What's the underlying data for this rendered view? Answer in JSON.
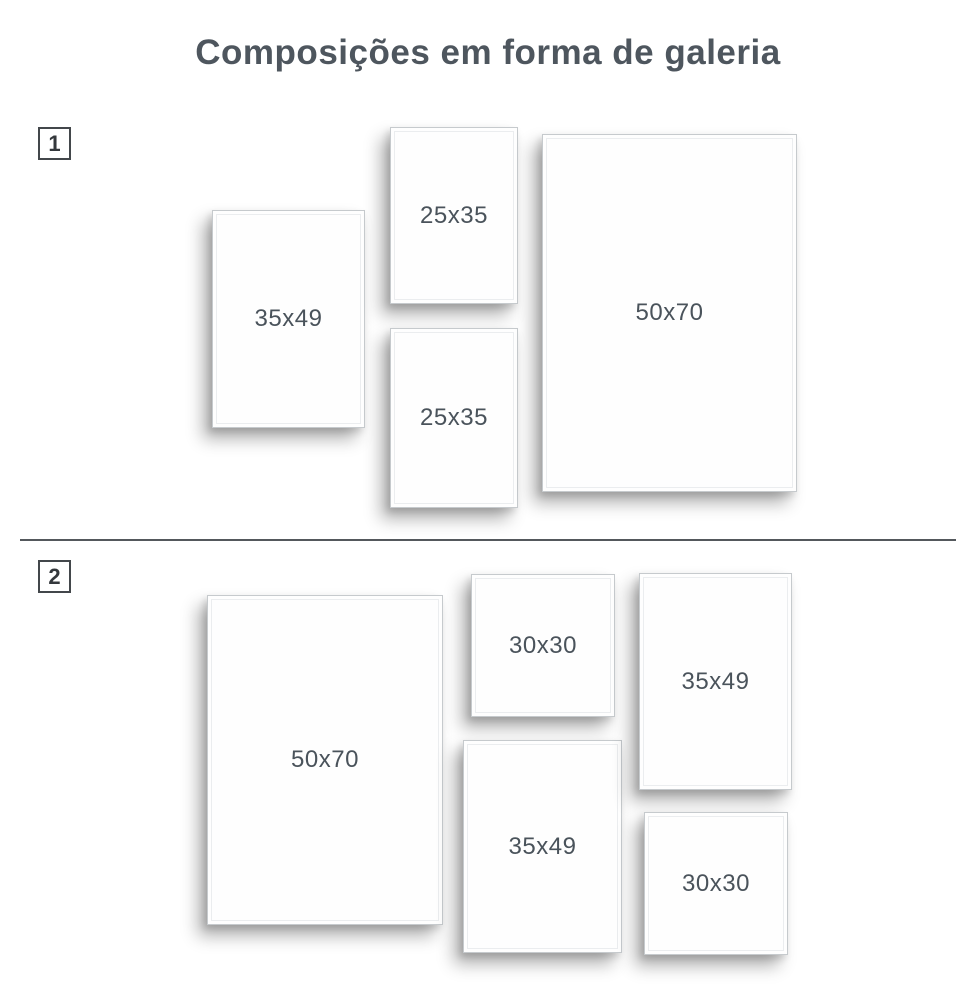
{
  "page": {
    "title": "Composições em forma de galeria"
  },
  "colors": {
    "title_text": "#4e565e",
    "label_text": "#4a535b",
    "frame_border": "#c6cacd",
    "divider": "#54585c",
    "badge_border": "#43474b",
    "background": "#ffffff"
  },
  "sections": [
    {
      "number": "1",
      "frames": [
        {
          "label": "35x49",
          "x": 212,
          "y": 210,
          "w": 153,
          "h": 218
        },
        {
          "label": "25x35",
          "x": 390,
          "y": 127,
          "w": 128,
          "h": 177
        },
        {
          "label": "25x35",
          "x": 390,
          "y": 328,
          "w": 128,
          "h": 180
        },
        {
          "label": "50x70",
          "x": 542,
          "y": 134,
          "w": 255,
          "h": 358
        }
      ]
    },
    {
      "number": "2",
      "frames": [
        {
          "label": "50x70",
          "x": 207,
          "y": 595,
          "w": 236,
          "h": 330
        },
        {
          "label": "30x30",
          "x": 471,
          "y": 574,
          "w": 144,
          "h": 143
        },
        {
          "label": "35x49",
          "x": 463,
          "y": 740,
          "w": 159,
          "h": 213
        },
        {
          "label": "35x49",
          "x": 639,
          "y": 573,
          "w": 153,
          "h": 217
        },
        {
          "label": "30x30",
          "x": 644,
          "y": 812,
          "w": 144,
          "h": 143
        }
      ]
    }
  ]
}
